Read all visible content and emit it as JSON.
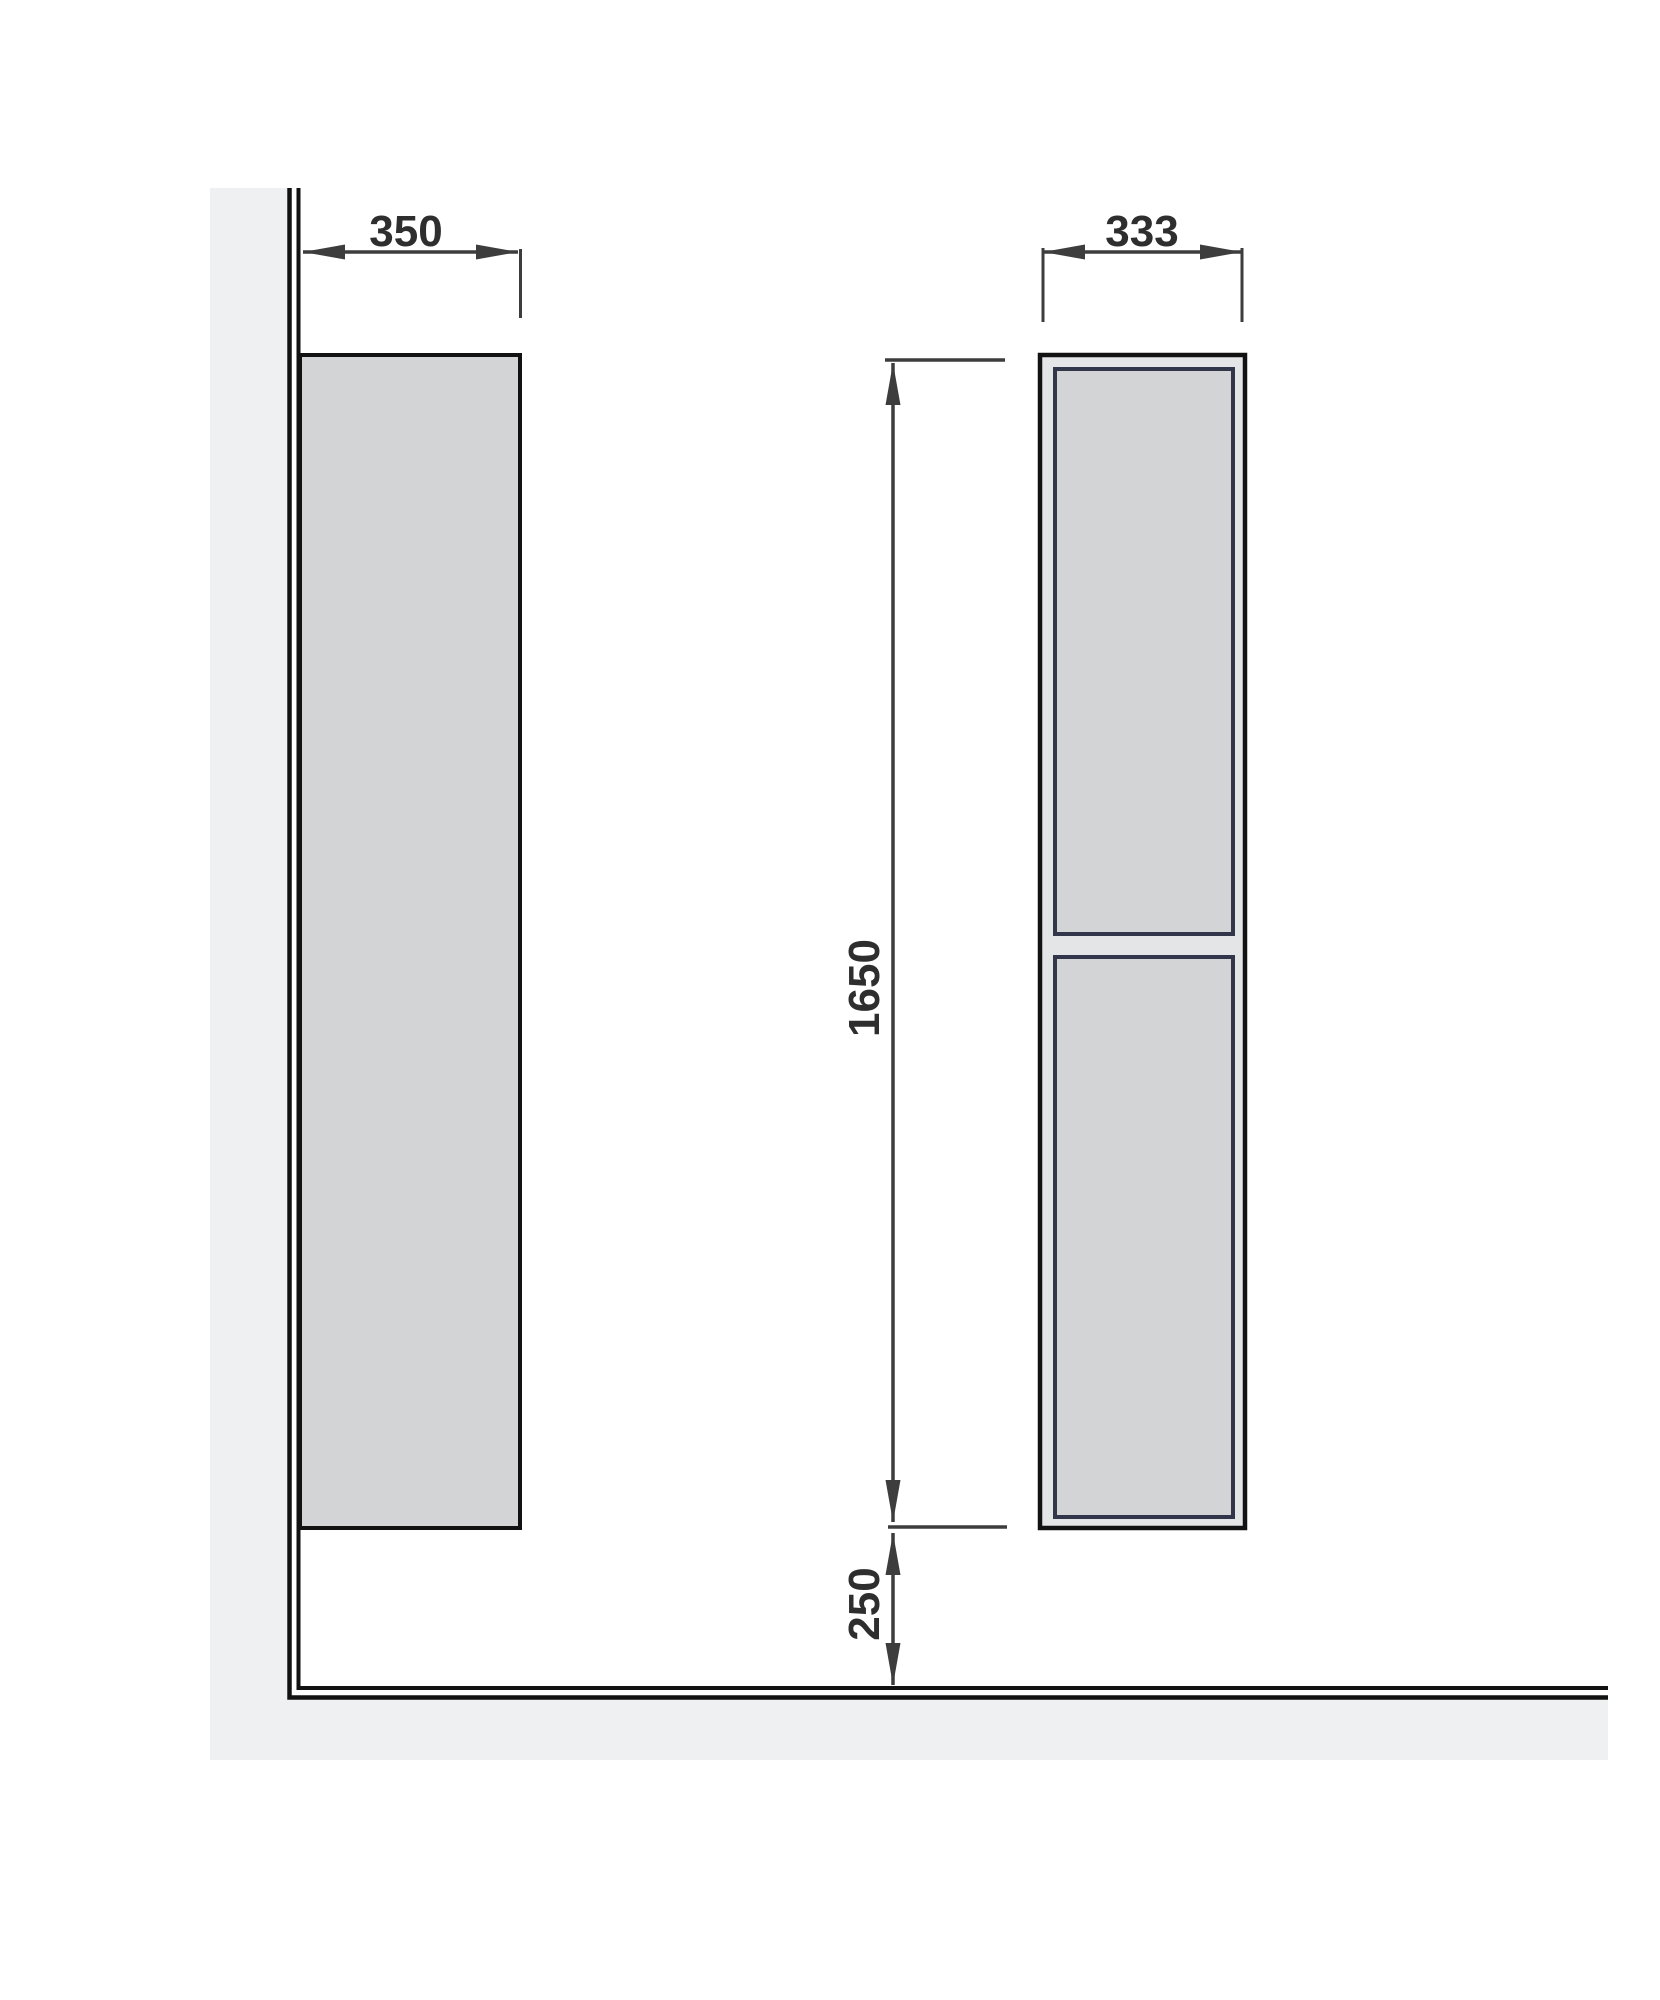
{
  "drawing": {
    "dimensions": {
      "depth": "350",
      "width": "333",
      "height": "1650",
      "clearance": "250"
    }
  },
  "colors": {
    "background": "#ffffff",
    "wall_floor_fill": "#eef0f2",
    "outline": "#121212",
    "cabinet_fill": "#d2d4d6",
    "carcass_fill": "#e4e5e7",
    "door_border": "#32364a",
    "dimension_lines": "#3d3d3d",
    "dimension_text": "#2e2e2e"
  }
}
